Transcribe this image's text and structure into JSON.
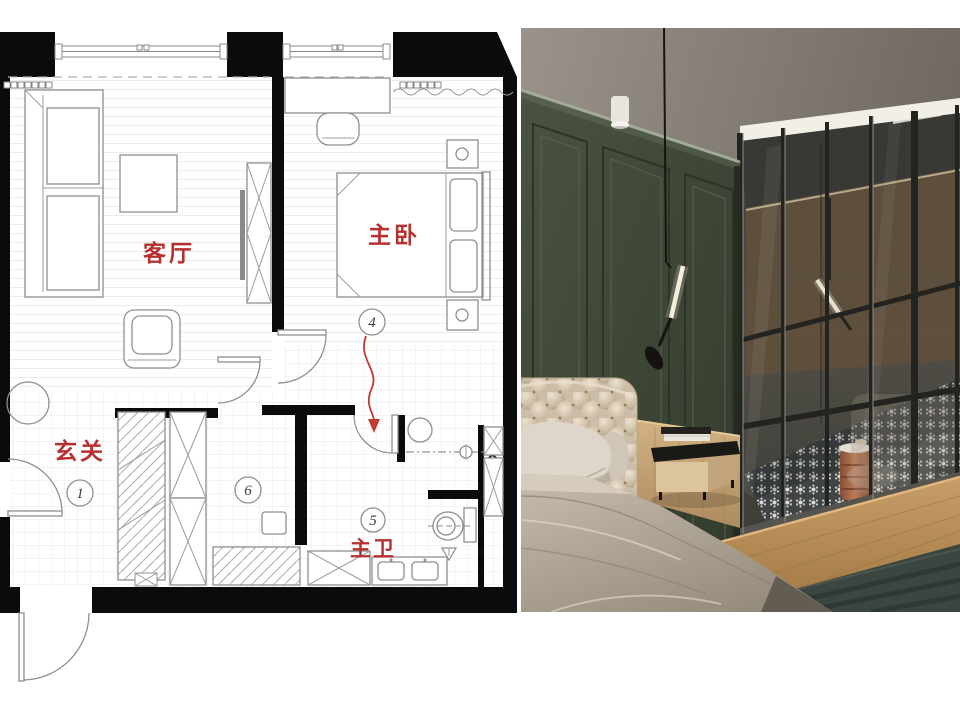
{
  "floor_plan": {
    "labels": {
      "living_room": "客厅",
      "master_bedroom": "主卧",
      "entrance": "玄关",
      "master_bath": "主卫"
    },
    "markers": {
      "entrance": "1",
      "bedroom": "4",
      "bath": "5",
      "closet": "6"
    },
    "colors": {
      "wall": "#0b0b0b",
      "furniture_line": "#8f8f8f",
      "label": "#b5302e",
      "arrow": "#c23b2e"
    }
  },
  "photo": {
    "objects": [
      "green-paneled-wall",
      "ceiling",
      "ceiling-spotlight",
      "pendant-lamp",
      "glass-partition",
      "light-strip",
      "bathroom-tile-floor",
      "terracotta-stool",
      "shower-lamp",
      "tufted-headboard",
      "pillows",
      "bed-blanket",
      "nightstand",
      "books",
      "wood-wainscot",
      "wood-floor",
      "green-carpet",
      "headboard-reflection"
    ],
    "colors": {
      "ceiling": "#8b847c",
      "wall_green": "#3f4639",
      "wainscot": "#c9a87b",
      "glass_frame": "#23231f",
      "light_strip": "#f2efe6",
      "headboard": "#d7cbb8",
      "blanket": "#b0a697",
      "wood_floor": "#b98e5c",
      "carpet": "#3a463f",
      "tile": "#3b3e41",
      "stool": "#b25f3f"
    }
  }
}
